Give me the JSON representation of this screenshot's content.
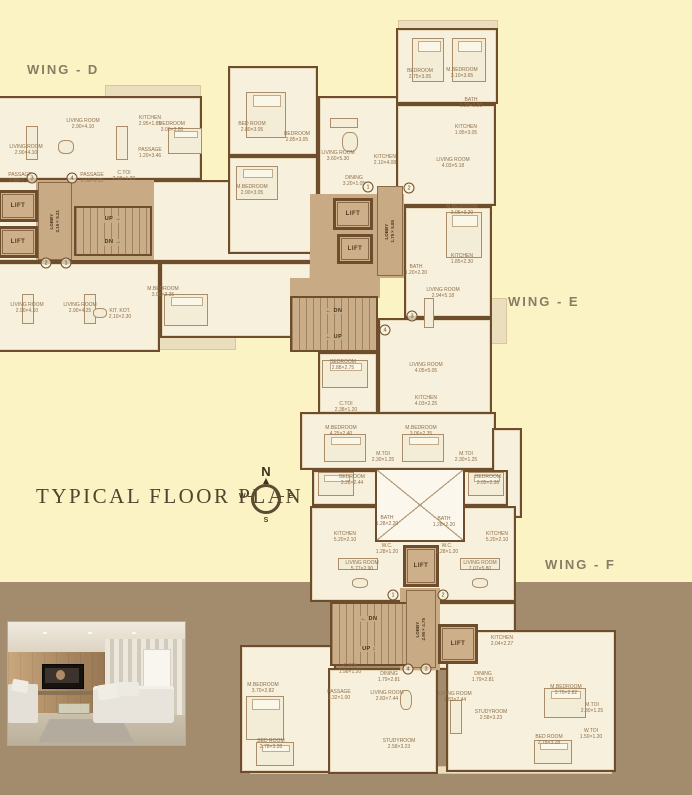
{
  "title": {
    "text": "TYPICAL FLOOR PLAN"
  },
  "wings": [
    {
      "id": "D",
      "label": "WING - D"
    },
    {
      "id": "E",
      "label": "WING - E"
    },
    {
      "id": "F",
      "label": "WING - F"
    }
  ],
  "compass": {
    "n": "N",
    "s": "S",
    "e": "E",
    "w": "W"
  },
  "colors": {
    "bg_top": "#fbf3c3",
    "bg_bottom": "#a38b6d",
    "wall": "#6e4d2d",
    "room_fill": "#f7f0dc",
    "core_fill": "#c8ab85",
    "shade_fill": "#eadebc",
    "wing_label": "#8b7b66",
    "title": "#51432f"
  },
  "plan": {
    "shades": [
      {
        "x": 105,
        "y": 85,
        "w": 96,
        "h": 16
      },
      {
        "x": 398,
        "y": 20,
        "w": 100,
        "h": 14
      },
      {
        "x": 96,
        "y": 336,
        "w": 140,
        "h": 14
      },
      {
        "x": 228,
        "y": 246,
        "w": 164,
        "h": 12
      },
      {
        "x": 250,
        "y": 766,
        "w": 362,
        "h": 8
      },
      {
        "x": 491,
        "y": 298,
        "w": 16,
        "h": 46
      }
    ],
    "rooms": [
      {
        "x": -12,
        "y": 96,
        "w": 214,
        "h": 84
      },
      {
        "x": -12,
        "y": 180,
        "w": 324,
        "h": 82
      },
      {
        "x": -12,
        "y": 262,
        "w": 172,
        "h": 90
      },
      {
        "x": 160,
        "y": 262,
        "w": 152,
        "h": 76
      },
      {
        "x": 228,
        "y": 66,
        "w": 90,
        "h": 90
      },
      {
        "x": 318,
        "y": 96,
        "w": 86,
        "h": 108
      },
      {
        "x": 396,
        "y": 28,
        "w": 102,
        "h": 76
      },
      {
        "x": 396,
        "y": 104,
        "w": 100,
        "h": 102
      },
      {
        "x": 228,
        "y": 156,
        "w": 90,
        "h": 98
      },
      {
        "x": 404,
        "y": 206,
        "w": 88,
        "h": 112
      },
      {
        "x": 378,
        "y": 318,
        "w": 114,
        "h": 96
      },
      {
        "x": 318,
        "y": 352,
        "w": 60,
        "h": 62
      },
      {
        "x": 300,
        "y": 412,
        "w": 196,
        "h": 58
      },
      {
        "x": 492,
        "y": 428,
        "w": 30,
        "h": 90
      },
      {
        "x": 312,
        "y": 470,
        "w": 196,
        "h": 36
      },
      {
        "x": 310,
        "y": 506,
        "w": 206,
        "h": 96
      },
      {
        "x": 240,
        "y": 645,
        "w": 96,
        "h": 128
      },
      {
        "x": 328,
        "y": 668,
        "w": 110,
        "h": 106
      },
      {
        "x": 436,
        "y": 602,
        "w": 80,
        "h": 68
      },
      {
        "x": 446,
        "y": 630,
        "w": 170,
        "h": 142
      }
    ],
    "cores": [
      {
        "x": 36,
        "y": 180,
        "w": 118,
        "h": 80
      },
      {
        "x": 310,
        "y": 194,
        "w": 94,
        "h": 84
      },
      {
        "x": 290,
        "y": 278,
        "w": 90,
        "h": 20
      },
      {
        "x": 400,
        "y": 588,
        "w": 40,
        "h": 82
      }
    ],
    "void": {
      "x": 375,
      "y": 468,
      "w": 90,
      "h": 74
    },
    "stairs": [
      {
        "x": 74,
        "y": 206,
        "w": 78,
        "h": 50,
        "rows": [
          "UP →",
          "DN →"
        ]
      },
      {
        "x": 290,
        "y": 296,
        "w": 88,
        "h": 56,
        "rows": [
          "← DN",
          "← UP"
        ]
      },
      {
        "x": 330,
        "y": 602,
        "w": 78,
        "h": 64,
        "rows": [
          "← DN",
          "UP ↓"
        ]
      }
    ],
    "lifts": [
      {
        "x": -2,
        "y": 190,
        "w": 40,
        "h": 32,
        "label": "LIFT"
      },
      {
        "x": -2,
        "y": 226,
        "w": 40,
        "h": 32,
        "label": "LIFT"
      },
      {
        "x": 333,
        "y": 198,
        "w": 40,
        "h": 32,
        "label": "LIFT"
      },
      {
        "x": 337,
        "y": 234,
        "w": 36,
        "h": 30,
        "label": "LIFT"
      },
      {
        "x": 403,
        "y": 545,
        "w": 36,
        "h": 42,
        "label": "LIFT"
      },
      {
        "x": 438,
        "y": 624,
        "w": 40,
        "h": 40,
        "label": "LIFT"
      }
    ],
    "lobbies": [
      {
        "x": 38,
        "y": 182,
        "w": 34,
        "h": 78,
        "label": "LOBBY\n2.15×5.21"
      },
      {
        "x": 377,
        "y": 186,
        "w": 26,
        "h": 90,
        "label": "LOBBY\n1.75×5.85"
      },
      {
        "x": 406,
        "y": 590,
        "w": 30,
        "h": 78,
        "label": "LOBBY\n2.90×4.75"
      }
    ],
    "room_labels": [
      {
        "x": 26,
        "y": 150,
        "t": "LIVING ROOM\n2.90×4.10"
      },
      {
        "x": 83,
        "y": 124,
        "t": "LIVING ROOM\n2.90×4.10"
      },
      {
        "x": 150,
        "y": 121,
        "t": "KITCHEN\n2.95×1.85"
      },
      {
        "x": 172,
        "y": 127,
        "t": "BEDROOM\n3.00×3.20"
      },
      {
        "x": 20,
        "y": 178,
        "t": "PASSAGE\n2.89×1.11"
      },
      {
        "x": 92,
        "y": 178,
        "t": "PASSAGE\n2.56×1.15"
      },
      {
        "x": 124,
        "y": 176,
        "t": "C.TOI\n2.98×1.20"
      },
      {
        "x": 150,
        "y": 153,
        "t": "PASSAGE\n1.20×3.46"
      },
      {
        "x": 27,
        "y": 308,
        "t": "LIVING ROOM\n2.90×4.10"
      },
      {
        "x": 80,
        "y": 308,
        "t": "LIVING ROOM\n2.90×4.25"
      },
      {
        "x": 120,
        "y": 314,
        "t": "KIT. KOT.\n2.10×2.30"
      },
      {
        "x": 163,
        "y": 292,
        "t": "M.BEDROOM\n3.00×3.35"
      },
      {
        "x": 252,
        "y": 127,
        "t": "BED ROOM\n2.80×3.05"
      },
      {
        "x": 297,
        "y": 137,
        "t": "BEDROOM\n2.85×3.05"
      },
      {
        "x": 338,
        "y": 156,
        "t": "LIVING ROOM\n3.60×5.30"
      },
      {
        "x": 385,
        "y": 160,
        "t": "KITCHEN\n2.10×4.08"
      },
      {
        "x": 354,
        "y": 181,
        "t": "DINING\n3.20×1.05"
      },
      {
        "x": 420,
        "y": 74,
        "t": "BEDROOM\n2.75×3.05"
      },
      {
        "x": 462,
        "y": 73,
        "t": "M.BEDROOM\n3.10×3.65"
      },
      {
        "x": 471,
        "y": 103,
        "t": "BATH\n1.20×2.20"
      },
      {
        "x": 466,
        "y": 130,
        "t": "KITCHEN\n1.95×3.05"
      },
      {
        "x": 453,
        "y": 163,
        "t": "LIVING ROOM\n4.03×5.18"
      },
      {
        "x": 252,
        "y": 190,
        "t": "M.BEDROOM\n2.90×3.05"
      },
      {
        "x": 462,
        "y": 210,
        "t": "M.BEDROOM\n3.05×3.20"
      },
      {
        "x": 462,
        "y": 259,
        "t": "KITCHEN\n1.85×2.30"
      },
      {
        "x": 416,
        "y": 270,
        "t": "BATH\n1.20×2.20"
      },
      {
        "x": 443,
        "y": 293,
        "t": "LIVING ROOM\n2.94×5.18"
      },
      {
        "x": 343,
        "y": 365,
        "t": "BEDROOM\n2.88×2.75"
      },
      {
        "x": 426,
        "y": 368,
        "t": "LIVING ROOM\n4.05×5.05"
      },
      {
        "x": 426,
        "y": 401,
        "t": "KITCHEN\n4.03×2.25"
      },
      {
        "x": 346,
        "y": 407,
        "t": "C.TOI\n2.38×1.20"
      },
      {
        "x": 341,
        "y": 431,
        "t": "M.BEDROOM\n4.25×2.40"
      },
      {
        "x": 421,
        "y": 431,
        "t": "M.BEDROOM\n3.06×2.35"
      },
      {
        "x": 383,
        "y": 457,
        "t": "M.TOI\n2.30×1.25"
      },
      {
        "x": 466,
        "y": 457,
        "t": "M.TOI\n2.30×1.25"
      },
      {
        "x": 352,
        "y": 480,
        "t": "BEDROOM\n3.28×2.44"
      },
      {
        "x": 488,
        "y": 480,
        "t": "BEDROOM\n3.05×2.36"
      },
      {
        "x": 387,
        "y": 521,
        "t": "BATH\n1.28×2.20"
      },
      {
        "x": 444,
        "y": 522,
        "t": "BATH\n1.28×2.20"
      },
      {
        "x": 387,
        "y": 549,
        "t": "W.C.\n1.28×1.20"
      },
      {
        "x": 447,
        "y": 549,
        "t": "W.C.\n1.28×1.20"
      },
      {
        "x": 345,
        "y": 537,
        "t": "KITCHEN\n5.20×2.10"
      },
      {
        "x": 497,
        "y": 537,
        "t": "KITCHEN\n5.20×2.10"
      },
      {
        "x": 362,
        "y": 566,
        "t": "LIVING ROOM\n5.77×2.90"
      },
      {
        "x": 480,
        "y": 566,
        "t": "LIVING ROOM\n7.07×5.80"
      },
      {
        "x": 350,
        "y": 669,
        "t": "C.TOI\n1.98×1.20"
      },
      {
        "x": 339,
        "y": 695,
        "t": "PASSAGE\n3.32×1.00"
      },
      {
        "x": 387,
        "y": 696,
        "t": "LIVING ROOM\n2.83×7.44"
      },
      {
        "x": 455,
        "y": 697,
        "t": "LIVING ROOM\n2.83×7.44"
      },
      {
        "x": 483,
        "y": 677,
        "t": "DINING\n1.79×2.81"
      },
      {
        "x": 389,
        "y": 677,
        "t": "DINING\n1.79×2.81"
      },
      {
        "x": 502,
        "y": 641,
        "t": "KITCHEN\n2.04×2.27"
      },
      {
        "x": 399,
        "y": 744,
        "t": "STUDYROOM\n2.58×3.23"
      },
      {
        "x": 491,
        "y": 715,
        "t": "STUDYROOM\n2.58×3.23"
      },
      {
        "x": 566,
        "y": 690,
        "t": "M.BEDROOM\n3.70×2.82"
      },
      {
        "x": 549,
        "y": 740,
        "t": "BED ROOM\n2.78×3.28"
      },
      {
        "x": 592,
        "y": 708,
        "t": "M.TOI\n2.30×1.25"
      },
      {
        "x": 591,
        "y": 734,
        "t": "W.TOI\n1.50×1.20"
      },
      {
        "x": 263,
        "y": 688,
        "t": "M.BEDROOM\n3.70×2.82"
      },
      {
        "x": 271,
        "y": 744,
        "t": "BED ROOM\n2.78×3.28"
      }
    ],
    "unit_numbers": [
      {
        "x": 46,
        "y": 263,
        "n": "2"
      },
      {
        "x": 66,
        "y": 263,
        "n": "1"
      },
      {
        "x": 32,
        "y": 178,
        "n": "3"
      },
      {
        "x": 72,
        "y": 178,
        "n": "4"
      },
      {
        "x": 368,
        "y": 187,
        "n": "1"
      },
      {
        "x": 409,
        "y": 188,
        "n": "2"
      },
      {
        "x": 412,
        "y": 316,
        "n": "3"
      },
      {
        "x": 385,
        "y": 330,
        "n": "4"
      },
      {
        "x": 393,
        "y": 595,
        "n": "1"
      },
      {
        "x": 443,
        "y": 595,
        "n": "2"
      },
      {
        "x": 408,
        "y": 669,
        "n": "4"
      },
      {
        "x": 426,
        "y": 669,
        "n": "3"
      }
    ],
    "furniture": [
      {
        "k": "bed",
        "x": 246,
        "y": 92,
        "w": 40,
        "h": 46
      },
      {
        "k": "bed",
        "x": 168,
        "y": 128,
        "w": 34,
        "h": 26
      },
      {
        "k": "bed",
        "x": 412,
        "y": 38,
        "w": 32,
        "h": 44
      },
      {
        "k": "bed",
        "x": 452,
        "y": 38,
        "w": 34,
        "h": 44
      },
      {
        "k": "bed",
        "x": 236,
        "y": 166,
        "w": 42,
        "h": 34
      },
      {
        "k": "bed",
        "x": 446,
        "y": 212,
        "w": 36,
        "h": 46
      },
      {
        "k": "bed",
        "x": 164,
        "y": 294,
        "w": 44,
        "h": 32
      },
      {
        "k": "bed",
        "x": 322,
        "y": 360,
        "w": 46,
        "h": 28
      },
      {
        "k": "bed",
        "x": 324,
        "y": 434,
        "w": 42,
        "h": 28
      },
      {
        "k": "bed",
        "x": 402,
        "y": 434,
        "w": 42,
        "h": 28
      },
      {
        "k": "bed",
        "x": 318,
        "y": 472,
        "w": 36,
        "h": 24
      },
      {
        "k": "bed",
        "x": 468,
        "y": 472,
        "w": 36,
        "h": 24
      },
      {
        "k": "bed",
        "x": 246,
        "y": 696,
        "w": 38,
        "h": 44
      },
      {
        "k": "bed",
        "x": 544,
        "y": 688,
        "w": 42,
        "h": 30
      },
      {
        "k": "bed",
        "x": 534,
        "y": 740,
        "w": 38,
        "h": 24
      },
      {
        "k": "bed",
        "x": 256,
        "y": 742,
        "w": 38,
        "h": 24
      },
      {
        "k": "sofa",
        "x": 26,
        "y": 126,
        "w": 12,
        "h": 34
      },
      {
        "k": "sofa",
        "x": 116,
        "y": 126,
        "w": 12,
        "h": 34
      },
      {
        "k": "sofa",
        "x": 22,
        "y": 294,
        "w": 12,
        "h": 30
      },
      {
        "k": "sofa",
        "x": 84,
        "y": 294,
        "w": 12,
        "h": 30
      },
      {
        "k": "sofa",
        "x": 330,
        "y": 118,
        "w": 28,
        "h": 10
      },
      {
        "k": "sofa",
        "x": 424,
        "y": 298,
        "w": 10,
        "h": 30
      },
      {
        "k": "sofa",
        "x": 338,
        "y": 558,
        "w": 40,
        "h": 12
      },
      {
        "k": "sofa",
        "x": 460,
        "y": 558,
        "w": 40,
        "h": 12
      },
      {
        "k": "sofa",
        "x": 450,
        "y": 700,
        "w": 12,
        "h": 34
      },
      {
        "k": "table",
        "x": 58,
        "y": 140,
        "w": 16,
        "h": 14
      },
      {
        "k": "table",
        "x": 93,
        "y": 308,
        "w": 14,
        "h": 10
      },
      {
        "k": "table",
        "x": 342,
        "y": 132,
        "w": 16,
        "h": 20
      },
      {
        "k": "table",
        "x": 352,
        "y": 578,
        "w": 16,
        "h": 10
      },
      {
        "k": "table",
        "x": 472,
        "y": 578,
        "w": 16,
        "h": 10
      },
      {
        "k": "table",
        "x": 400,
        "y": 690,
        "w": 12,
        "h": 20
      }
    ]
  }
}
